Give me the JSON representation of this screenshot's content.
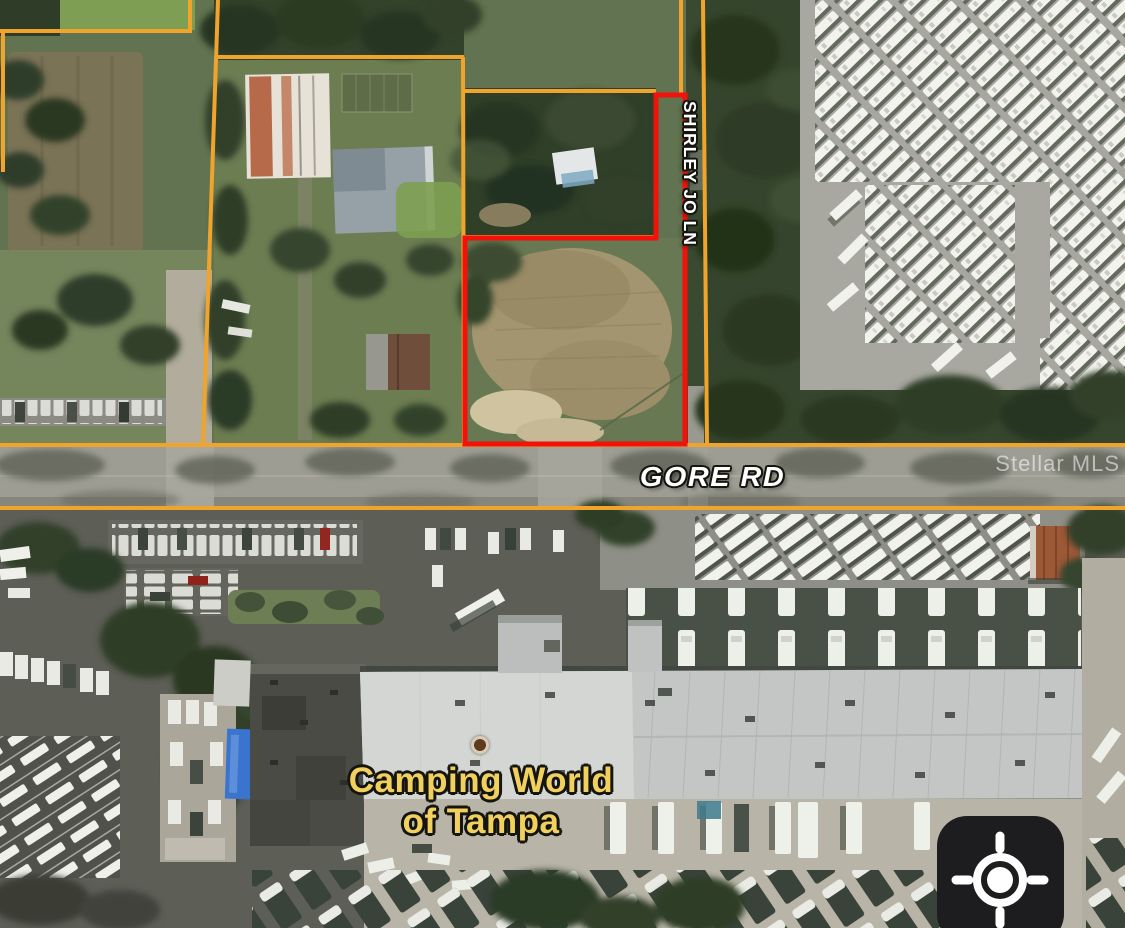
{
  "map": {
    "street_labels": {
      "shirley": "SHIRLEY JO LN",
      "gore": "GORE RD"
    },
    "business_label": {
      "line1": "Camping World",
      "line2": "of Tampa"
    },
    "watermark": "Stellar MLS",
    "markers": {
      "poi_dot": "camping-world-location"
    },
    "controls": {
      "locate_icon": "gps-crosshair"
    },
    "colors": {
      "parcel_boundary_orange": "#f0a42c",
      "subject_parcel_red": "#f2120a",
      "business_label_yellow": "#f2d05e",
      "street_label_white": "#ffffff",
      "locate_button_bg": "#1d1d1f",
      "poi_dot_brown": "#5d3b20"
    }
  }
}
